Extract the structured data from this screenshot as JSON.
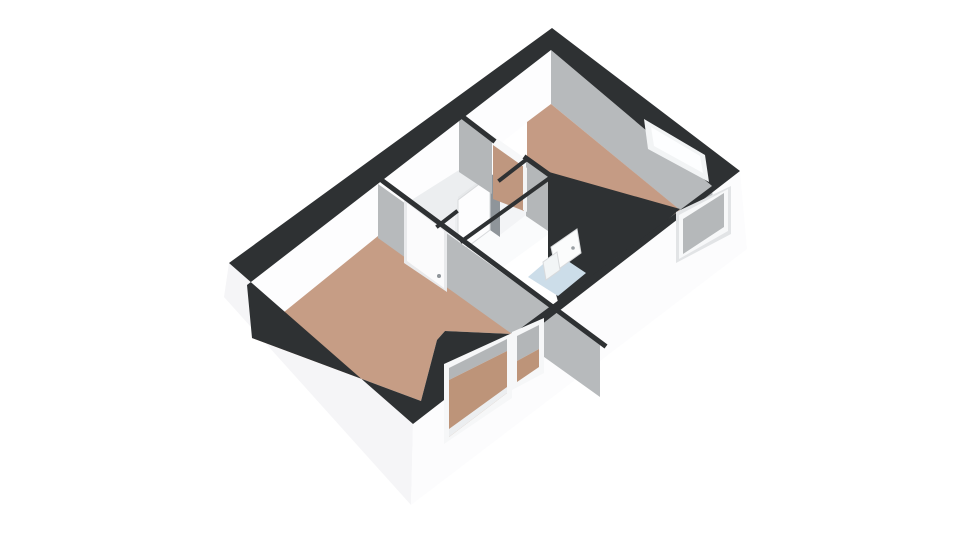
{
  "scene": {
    "type": "floorplan-3d-isometric",
    "background": "#ffffff",
    "canvas_width": 960,
    "canvas_height": 540
  },
  "palette": {
    "wall_top_black": "#2e3133",
    "exterior_white": "#f8f8fa",
    "interior_lit_white": "#fdfdfe",
    "interior_shaded_gray": "#b7babc",
    "floor_terracotta": "#c59b84",
    "floor_hallway": "#eceef0",
    "floor_bathroom": "#ccdde9",
    "glass_white": "#fdfeff",
    "door_white": "#fbfbfc"
  },
  "rooms": [
    {
      "name": "living-room",
      "floor": "terracotta"
    },
    {
      "name": "bedroom",
      "floor": "terracotta"
    },
    {
      "name": "hallway",
      "floor": "white"
    },
    {
      "name": "closet",
      "floor": "white"
    },
    {
      "name": "bathroom",
      "floor": "light-blue"
    }
  ],
  "shapes": [
    {
      "name": "exterior-wall-left-front",
      "type": "polygon",
      "points": [
        [
          229,
          263
        ],
        [
          413,
          424
        ],
        [
          411,
          505
        ],
        [
          224,
          297
        ]
      ],
      "fill": "#f5f5f7"
    },
    {
      "name": "exterior-wall-right-front",
      "type": "polygon",
      "points": [
        [
          413,
          424
        ],
        [
          740,
          171
        ],
        [
          747,
          249
        ],
        [
          411,
          505
        ]
      ],
      "fill": "#fcfcfd"
    },
    {
      "name": "interior-wall-top-left",
      "type": "polygon",
      "points": [
        [
          551,
          50
        ],
        [
          247,
          285
        ],
        [
          252,
          338
        ],
        [
          551,
          104
        ]
      ],
      "fill": "#fdfdfe"
    },
    {
      "name": "interior-wall-top-right",
      "type": "polygon",
      "points": [
        [
          551,
          50
        ],
        [
          712,
          186
        ],
        [
          715,
          239
        ],
        [
          551,
          104
        ]
      ],
      "fill": "#b7babc"
    },
    {
      "name": "bedroom-floor",
      "type": "polygon",
      "points": [
        [
          551,
          104
        ],
        [
          680,
          210
        ],
        [
          662,
          223
        ],
        [
          562,
          200
        ],
        [
          549,
          174
        ],
        [
          527,
          159
        ],
        [
          527,
          122
        ]
      ],
      "fill": "#c59b84"
    },
    {
      "name": "living-room-floor",
      "type": "polygon",
      "points": [
        [
          378,
          236
        ],
        [
          513,
          334
        ],
        [
          445,
          331
        ],
        [
          437,
          340
        ],
        [
          421,
          401
        ],
        [
          252,
          338
        ]
      ],
      "fill": "#c69d85"
    },
    {
      "name": "hallway-floor",
      "type": "polygon",
      "points": [
        [
          459,
          170
        ],
        [
          492,
          194
        ],
        [
          494,
          218
        ],
        [
          466,
          252
        ],
        [
          402,
          206
        ]
      ],
      "fill": "#eceef0"
    },
    {
      "name": "closet-right-wall-face",
      "type": "polygon",
      "points": [
        [
          550,
          178
        ],
        [
          462,
          242
        ],
        [
          462,
          297
        ],
        [
          550,
          233
        ]
      ],
      "fill": "#fafbfc"
    },
    {
      "name": "closet-back-wall-face",
      "type": "polygon",
      "points": [
        [
          526,
          161
        ],
        [
          551,
          179
        ],
        [
          551,
          233
        ],
        [
          526,
          216
        ]
      ],
      "fill": "#b4b7b9"
    },
    {
      "name": "hall-partition-upper-face",
      "type": "polygon",
      "points": [
        [
          526,
          160
        ],
        [
          500,
          180
        ],
        [
          500,
          235
        ],
        [
          526,
          215
        ]
      ],
      "fill": "#f3f4f6"
    },
    {
      "name": "open-door-gap",
      "type": "polygon",
      "points": [
        [
          490,
          173
        ],
        [
          500,
          180
        ],
        [
          500,
          237
        ],
        [
          490,
          230
        ]
      ],
      "fill": "#8f959a"
    },
    {
      "name": "open-door-top-edge",
      "type": "polygon",
      "points": [
        [
          458,
          197
        ],
        [
          490,
          173
        ],
        [
          490,
          178
        ],
        [
          458,
          202
        ]
      ],
      "fill": "#e6e8ea"
    },
    {
      "name": "open-door-panel",
      "type": "polygon",
      "points": [
        [
          458,
          200
        ],
        [
          490,
          176
        ],
        [
          490,
          230
        ],
        [
          458,
          254
        ]
      ],
      "fill": "#fdfdfe",
      "stroke": "#d8dadc"
    },
    {
      "name": "hall-partition-lower-face",
      "type": "polygon",
      "points": [
        [
          455,
          213
        ],
        [
          438,
          226
        ],
        [
          438,
          281
        ],
        [
          455,
          268
        ]
      ],
      "fill": "#f3f4f6"
    },
    {
      "name": "bedroom-front-wall-face",
      "type": "polygon",
      "points": [
        [
          459,
          117
        ],
        [
          492,
          139
        ],
        [
          492,
          194
        ],
        [
          459,
          172
        ]
      ],
      "fill": "#b4b7b9"
    },
    {
      "name": "bedroom-doorway-lintel",
      "type": "polygon",
      "points": [
        [
          492,
          135
        ],
        [
          526,
          159
        ],
        [
          526,
          169
        ],
        [
          492,
          145
        ]
      ],
      "fill": "#f7f8f9"
    },
    {
      "name": "bedroom-doorway-floor",
      "type": "polygon",
      "points": [
        [
          493,
          145
        ],
        [
          524,
          167
        ],
        [
          524,
          211
        ],
        [
          493,
          199
        ]
      ],
      "fill": "#bf977f"
    },
    {
      "name": "bedroom-doorway-jamb",
      "type": "polygon",
      "points": [
        [
          523,
          165
        ],
        [
          527,
          168
        ],
        [
          527,
          212
        ],
        [
          523,
          210
        ]
      ],
      "fill": "#f3f4f5"
    },
    {
      "name": "bathroom-walls-top-black",
      "type": "polygon",
      "points": [
        [
          549,
          172
        ],
        [
          680,
          209
        ],
        [
          664,
          223
        ],
        [
          616,
          258
        ],
        [
          558,
          302
        ],
        [
          548,
          262
        ],
        [
          548,
          178
        ]
      ],
      "fill": "#2e3133"
    },
    {
      "name": "bathroom-floor",
      "type": "polygon",
      "points": [
        [
          528,
          277
        ],
        [
          556,
          253
        ],
        [
          586,
          273
        ],
        [
          558,
          296
        ]
      ],
      "fill": "#ccdde9"
    },
    {
      "name": "bathroom-door",
      "type": "polygon",
      "points": [
        [
          551,
          247
        ],
        [
          577,
          229
        ],
        [
          581,
          253
        ],
        [
          556,
          271
        ]
      ],
      "fill": "#fbfcfc",
      "stroke": "#d8dadc"
    },
    {
      "name": "bathroom-door-handle",
      "type": "circle",
      "cx": 573,
      "cy": 248,
      "r": 1.8,
      "fill": "#9aa0a4"
    },
    {
      "name": "bathroom-sink",
      "type": "polygon",
      "points": [
        [
          543,
          262
        ],
        [
          557,
          252
        ],
        [
          560,
          270
        ],
        [
          546,
          280
        ]
      ],
      "fill": "#f2f5f6",
      "stroke": "#d8dadc"
    },
    {
      "name": "living-room-back-wall-face",
      "type": "polygon",
      "points": [
        [
          378,
          184
        ],
        [
          600,
          343
        ],
        [
          600,
          397
        ],
        [
          378,
          238
        ]
      ],
      "fill": "#b7babc"
    },
    {
      "name": "living-room-door-frame",
      "type": "polygon",
      "points": [
        [
          404,
          199
        ],
        [
          447,
          231
        ],
        [
          447,
          292
        ],
        [
          404,
          263
        ]
      ],
      "fill": "#e9eaec"
    },
    {
      "name": "living-room-door",
      "type": "polygon",
      "points": [
        [
          407,
          203
        ],
        [
          444,
          231
        ],
        [
          444,
          288
        ],
        [
          407,
          261
        ]
      ],
      "fill": "#fbfbfc"
    },
    {
      "name": "living-room-door-handle",
      "type": "circle",
      "cx": 439,
      "cy": 276,
      "r": 2,
      "fill": "#8f959a"
    },
    {
      "name": "living-room-back-wall-top",
      "type": "line",
      "points": [
        [
          376,
          176
        ],
        [
          604,
          345
        ]
      ],
      "stroke": "#2e3133",
      "width": 5
    },
    {
      "name": "bedroom-front-wall-top",
      "type": "line",
      "points": [
        [
          459,
          114
        ],
        [
          493,
          140
        ]
      ],
      "stroke": "#2e3133",
      "width": 5
    },
    {
      "name": "closet-back-wall-top",
      "type": "line",
      "points": [
        [
          526,
          158
        ],
        [
          551,
          176
        ]
      ],
      "stroke": "#2e3133",
      "width": 5
    },
    {
      "name": "closet-right-wall-top",
      "type": "line",
      "points": [
        [
          551,
          177
        ],
        [
          462,
          241
        ]
      ],
      "stroke": "#2e3133",
      "width": 4
    },
    {
      "name": "hall-partition-upper-top",
      "type": "line",
      "points": [
        [
          527,
          159
        ],
        [
          500,
          180
        ]
      ],
      "stroke": "#2e3133",
      "width": 4
    },
    {
      "name": "hall-partition-lower-top",
      "type": "line",
      "points": [
        [
          456,
          212
        ],
        [
          438,
          226
        ]
      ],
      "stroke": "#2e3133",
      "width": 4
    },
    {
      "name": "exterior-wall-top-band",
      "type": "rings",
      "outer": [
        [
          552,
          28
        ],
        [
          740,
          171
        ],
        [
          413,
          424
        ],
        [
          229,
          263
        ]
      ],
      "inner": [
        [
          551,
          50
        ],
        [
          712,
          186
        ],
        [
          664,
          222
        ],
        [
          513,
          334
        ],
        [
          445,
          331
        ],
        [
          437,
          340
        ],
        [
          421,
          401
        ],
        [
          252,
          338
        ],
        [
          247,
          285
        ]
      ],
      "fill": "#2e3133"
    },
    {
      "name": "bedroom-back-window-frame",
      "type": "polygon",
      "points": [
        [
          644,
          119
        ],
        [
          705,
          155
        ],
        [
          709,
          182
        ],
        [
          648,
          149
        ]
      ],
      "fill": "#f2f4f5"
    },
    {
      "name": "bedroom-back-window-glass",
      "type": "polygon",
      "points": [
        [
          651,
          127
        ],
        [
          700,
          156
        ],
        [
          703,
          173
        ],
        [
          654,
          146
        ]
      ],
      "fill": "#fdfeff"
    },
    {
      "name": "bedroom-side-window-recess",
      "type": "polygon",
      "points": [
        [
          676,
          212
        ],
        [
          731,
          186
        ],
        [
          731,
          234
        ],
        [
          676,
          263
        ]
      ],
      "fill": "#e2e4e6"
    },
    {
      "name": "bedroom-side-window-frame",
      "type": "polygon",
      "points": [
        [
          679,
          215
        ],
        [
          728,
          189
        ],
        [
          728,
          231
        ],
        [
          679,
          259
        ]
      ],
      "fill": "#f7f8f9"
    },
    {
      "name": "bedroom-side-window-glass",
      "type": "polygon",
      "points": [
        [
          683,
          219
        ],
        [
          724,
          193
        ],
        [
          724,
          227
        ],
        [
          683,
          254
        ]
      ],
      "fill": "#b5b8ba"
    },
    {
      "name": "living-window-left-frame",
      "type": "polygon",
      "points": [
        [
          444,
          364
        ],
        [
          512,
          333
        ],
        [
          512,
          398
        ],
        [
          444,
          444
        ]
      ],
      "fill": "#f6f7f8"
    },
    {
      "name": "living-window-left-glass-upper",
      "type": "polygon",
      "points": [
        [
          449,
          368
        ],
        [
          507,
          339
        ],
        [
          507,
          351
        ],
        [
          449,
          380
        ]
      ],
      "fill": "#b3b6b8"
    },
    {
      "name": "living-window-left-glass-floor",
      "type": "polygon",
      "points": [
        [
          449,
          380
        ],
        [
          507,
          351
        ],
        [
          507,
          393
        ],
        [
          449,
          437
        ]
      ],
      "fill": "#bd9479"
    },
    {
      "name": "living-window-left-sill",
      "type": "polygon",
      "points": [
        [
          449,
          429
        ],
        [
          507,
          387
        ],
        [
          507,
          393
        ],
        [
          449,
          437
        ]
      ],
      "fill": "#eceef0"
    },
    {
      "name": "living-window-right-frame",
      "type": "polygon",
      "points": [
        [
          512,
          332
        ],
        [
          544,
          318
        ],
        [
          544,
          373
        ],
        [
          512,
          390
        ]
      ],
      "fill": "#f6f7f8"
    },
    {
      "name": "living-window-right-glass-upper",
      "type": "polygon",
      "points": [
        [
          517,
          336
        ],
        [
          539,
          325
        ],
        [
          539,
          349
        ],
        [
          517,
          361
        ]
      ],
      "fill": "#b3b6b8"
    },
    {
      "name": "living-window-right-glass-floor",
      "type": "polygon",
      "points": [
        [
          517,
          361
        ],
        [
          539,
          349
        ],
        [
          539,
          367
        ],
        [
          517,
          382
        ]
      ],
      "fill": "#bd9479"
    }
  ]
}
